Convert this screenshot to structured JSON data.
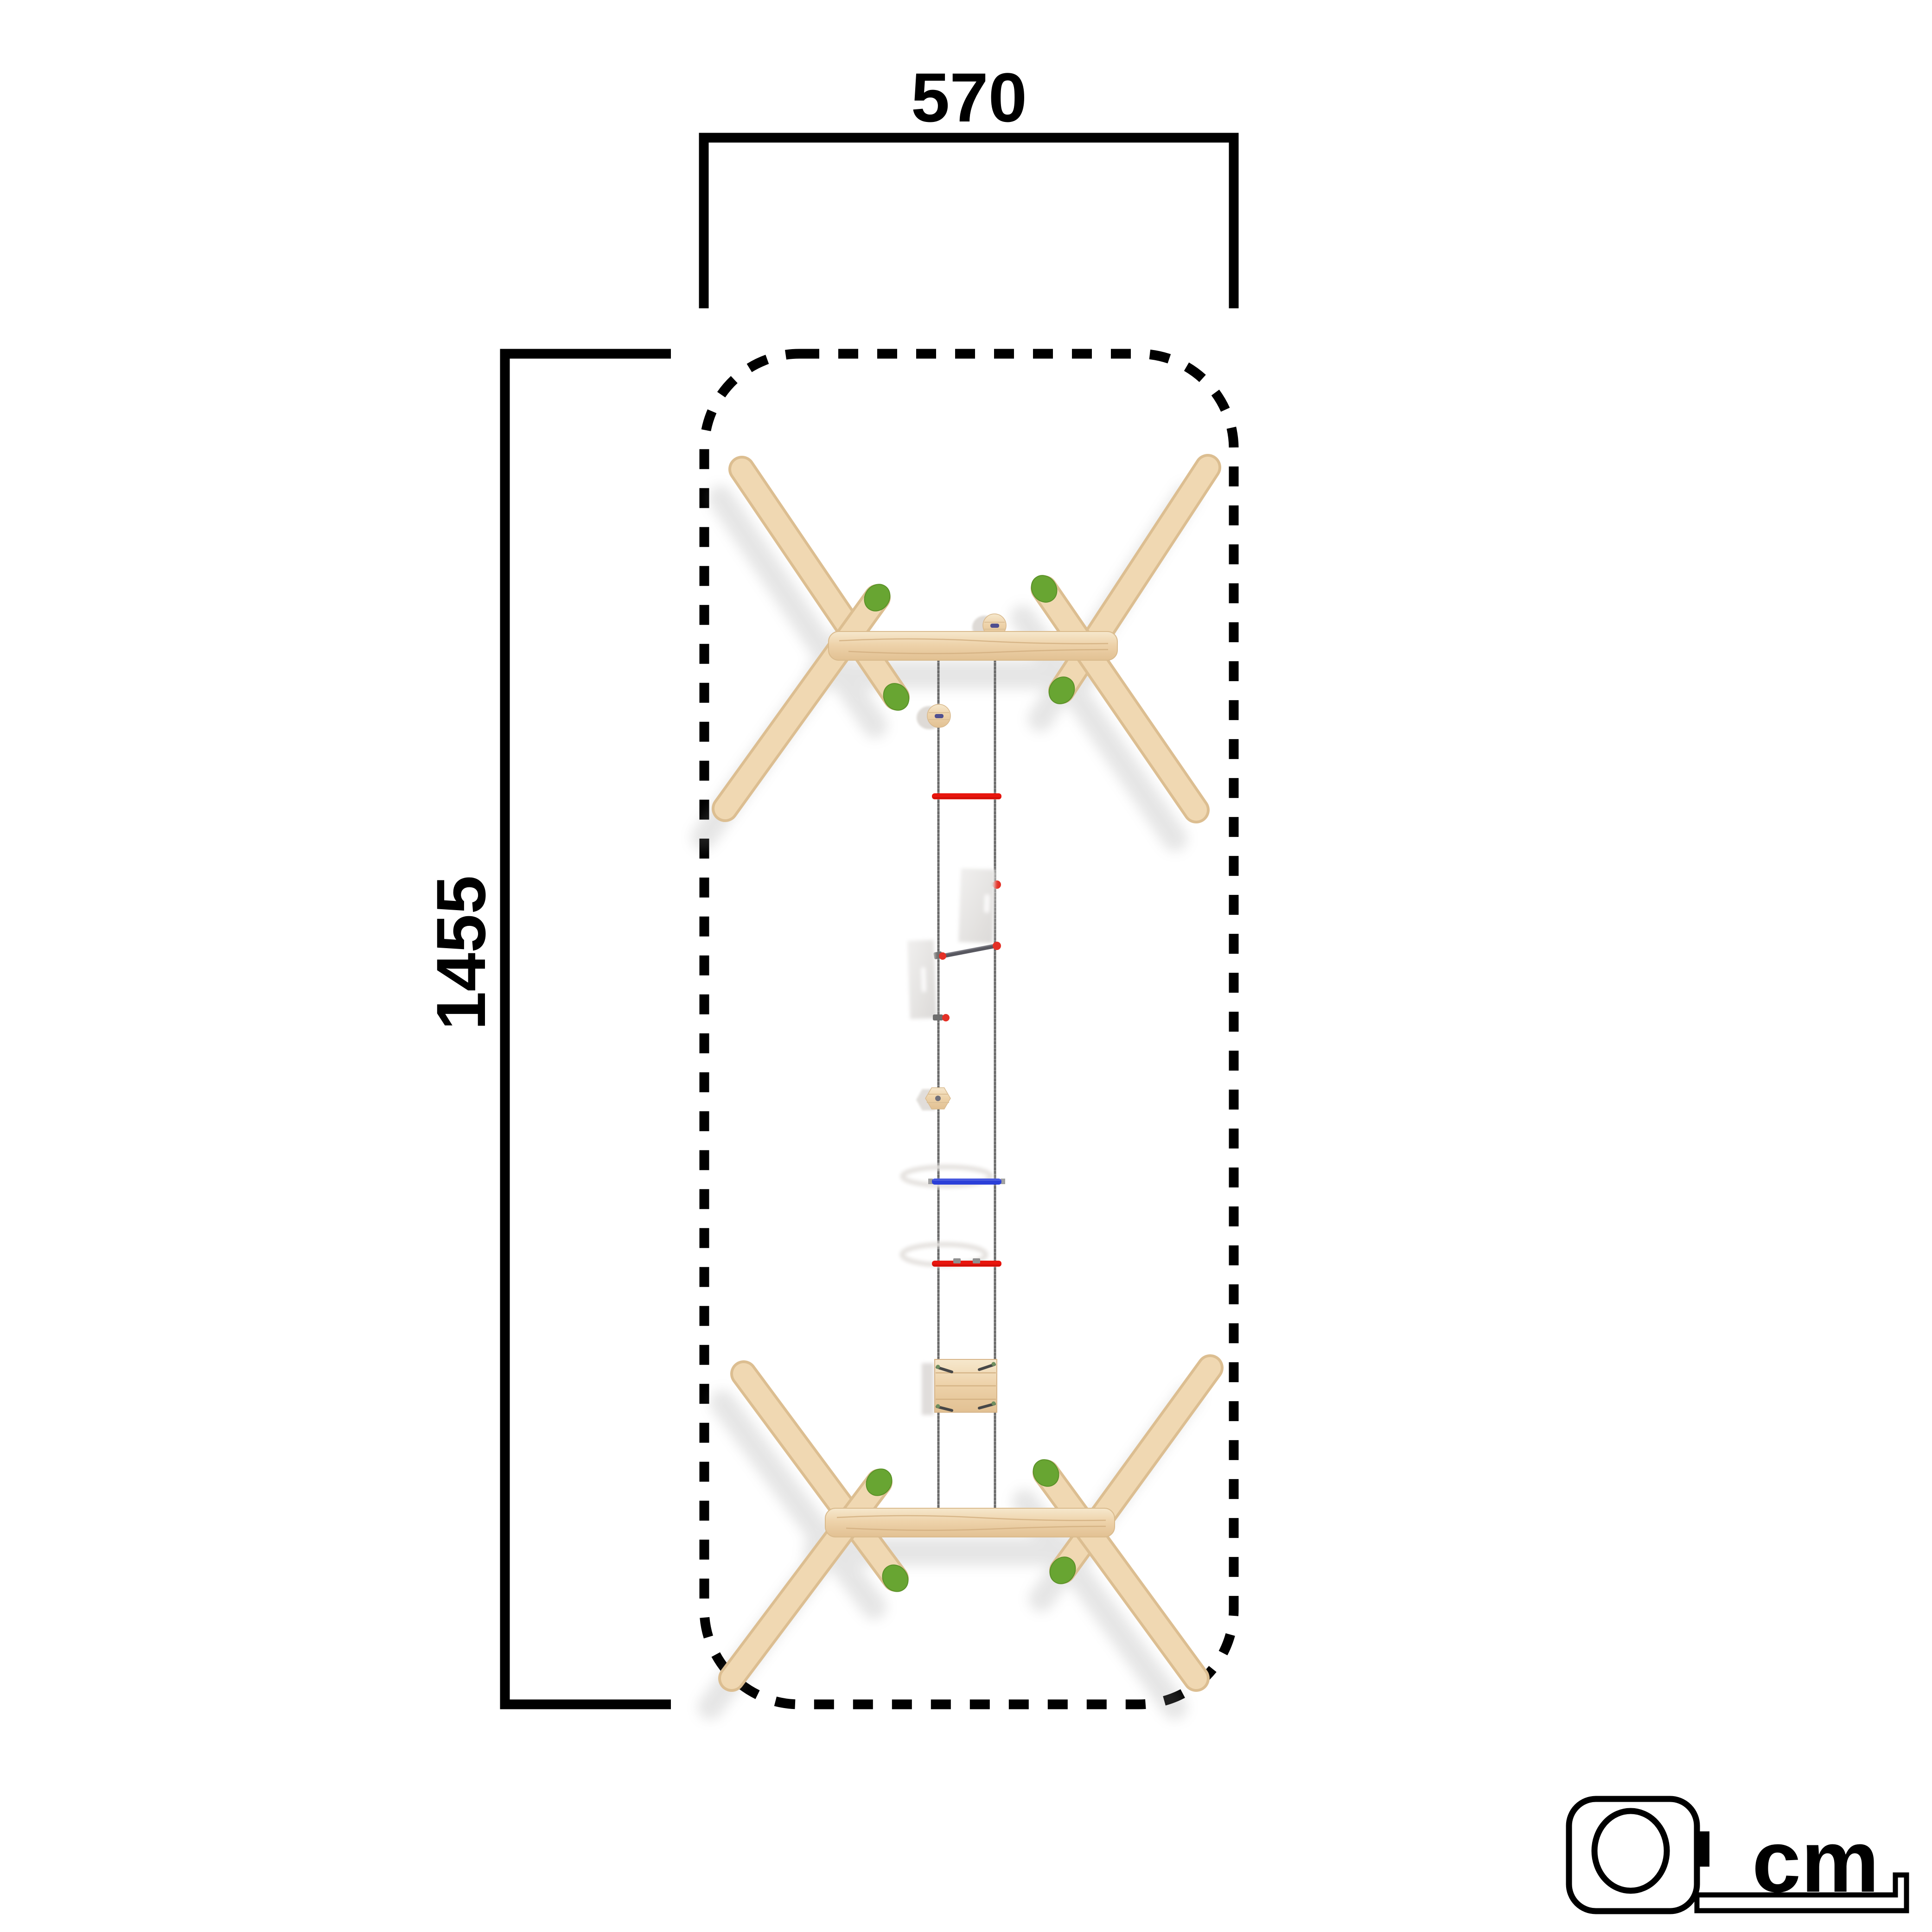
{
  "diagram": {
    "type": "product-footprint-dimension-drawing",
    "dimensions": {
      "width": {
        "value": "570",
        "orientation": "horizontal"
      },
      "height": {
        "value": "1455",
        "orientation": "vertical"
      }
    },
    "unit": {
      "label": "cm"
    },
    "icons": {
      "unit_icon": "tape-measure-icon"
    },
    "structure": {
      "top_frame": "wooden-x-frame",
      "bottom_frame": "wooden-x-frame",
      "center": [
        "rope-pair",
        "wood-disc-step",
        "wood-disc-step",
        "red-rung",
        "shadow-panel",
        "diagonal-bar",
        "shadow-panel",
        "hex-wood-step",
        "blue-rung",
        "red-rung",
        "wood-platform"
      ]
    },
    "colors": {
      "outline": "#000000",
      "wood_light": "#f0d8b2",
      "wood_mid": "#ecd2a9",
      "wood_dark": "#dcbe91",
      "green_cap": "#68a532",
      "rung_red": "#e8150d",
      "rung_blue": "#2b3fd8",
      "rope": "#696969",
      "soft_shadow": "#dedad6"
    }
  }
}
